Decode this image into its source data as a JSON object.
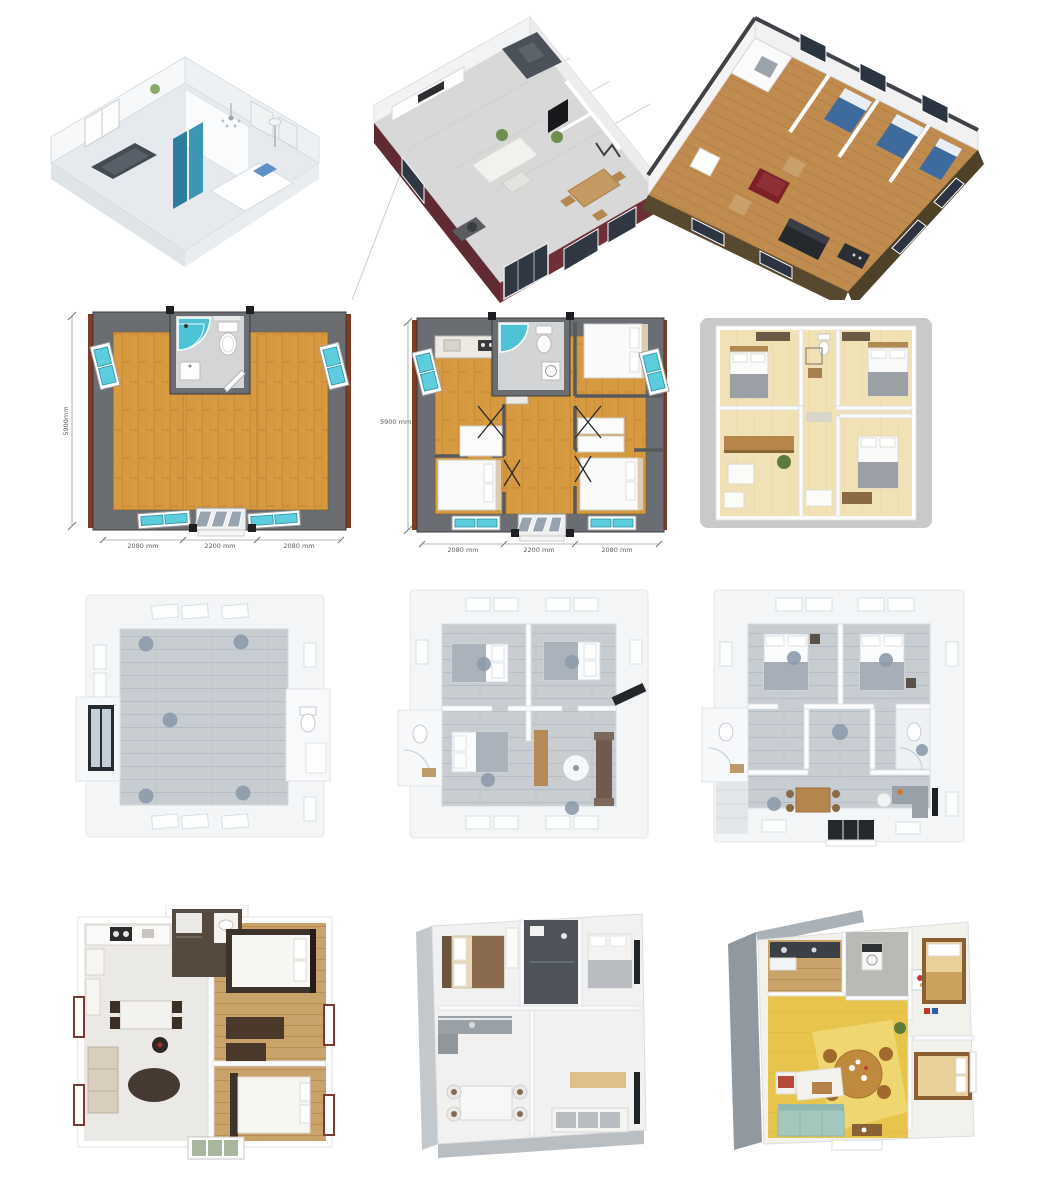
{
  "page": {
    "title": "Expandable container house floor-plan image gallery",
    "background_color": "#ffffff",
    "grid": {
      "rows": 4,
      "columns": 3
    }
  },
  "panels": [
    {
      "id": "render-iso-white-interior",
      "row": 1,
      "col": 1,
      "description": "3D isometric cutaway render, white interior, teal wardrobe, sofa, bed, chandelier"
    },
    {
      "id": "render-iso-maroon-house",
      "row": 1,
      "col": 2,
      "description": "3D isometric render, maroon exterior walls, kitchen, living and dining areas"
    },
    {
      "id": "render-iso-brown-container",
      "row": 1,
      "col": 3,
      "description": "3D isometric render, brown container home, wood floor, three blue beds, lounge"
    },
    {
      "id": "cad-plan-open-layout",
      "row": 2,
      "col": 1,
      "description": "Top-down CAD plan, open bamboo floor, central bathroom with shower and toilet",
      "dimensions": {
        "height": "5900mm",
        "widths": [
          "2080 mm",
          "2200 mm",
          "2080 mm"
        ]
      }
    },
    {
      "id": "cad-plan-three-bedroom",
      "row": 2,
      "col": 2,
      "description": "Top-down CAD plan, kitchen, three beds, central bathroom and hallway",
      "dimensions": {
        "height": "5900 mm",
        "widths": [
          "2080 mm",
          "2200 mm",
          "2080 mm"
        ]
      }
    },
    {
      "id": "render-top-warm-three-bed",
      "row": 2,
      "col": 3,
      "description": "Top-down warm-lit render, three bedrooms, bathroom, kitchen with wood counter"
    },
    {
      "id": "render-top-empty-studio",
      "row": 3,
      "col": 1,
      "description": "Top-down render, empty gray-plank studio, right bathroom pod, left entry door, five ceiling lights"
    },
    {
      "id": "render-top-three-bed-living",
      "row": 3,
      "col": 2,
      "description": "Top-down render, two upper bedrooms, left bathroom, lower bedroom and living room with sofa"
    },
    {
      "id": "render-top-two-bed-two-bath",
      "row": 3,
      "col": 3,
      "description": "Top-down render, two bedrooms, two bathrooms, dining table and sofa, center entry"
    },
    {
      "id": "render-top-furnished-flat",
      "row": 4,
      "col": 1,
      "description": "Top-down render, kitchen and lounge on tile, dark bathroom, two wood-floor bedrooms"
    },
    {
      "id": "render-iso-white-flat",
      "row": 4,
      "col": 2,
      "description": "3D render, white interior, two bedrooms, dark bathroom, kitchen, dining set and sofa"
    },
    {
      "id": "render-iso-yellow-flat",
      "row": 4,
      "col": 3,
      "description": "3D render, yellow floor, round dining table, teal sofa, two bedrooms, kitchen and laundry"
    }
  ],
  "colors": {
    "accent_teal_glass": "#55c8d9",
    "bamboo_floor": "#d89a40",
    "plan_wall_gray": "#6a6d71",
    "plan_trim_brown": "#7e3d22",
    "maroon_exterior": "#6e3038",
    "container_brown": "#57492f",
    "bed_blue": "#3e6b9e",
    "warm_floor": "#f3e3b4",
    "cool_plank_floor": "#c8cdd2",
    "yellow_floor": "#e7c54d",
    "sofa_teal": "#a3c9bf",
    "ceiling_light_gray": "#8d9bab"
  }
}
